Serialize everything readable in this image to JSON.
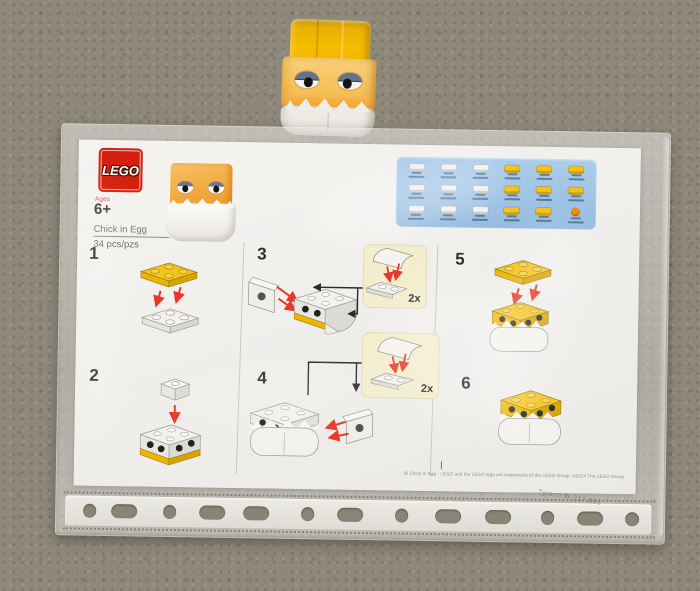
{
  "sheet": {
    "brand": "LEGO",
    "ages_label": "Ages",
    "age": "6+",
    "title": "Chick in Egg",
    "piece_count": "34 pcs/pzs",
    "steps": [
      "1",
      "2",
      "3",
      "4",
      "5",
      "6"
    ],
    "callouts": [
      {
        "qty": "2x"
      },
      {
        "qty": "2x"
      }
    ],
    "fine_print": "BI Chick in Egg · LEGO and the LEGO logo are trademarks of the LEGO Group. ©2024 The LEGO Group"
  },
  "sleeve": {
    "recycling_stamp": "Tyreco ♻ 317.881"
  },
  "parts_box": {
    "cells": [
      "white",
      "white",
      "white",
      "yellow",
      "yellow",
      "yellow",
      "white",
      "white",
      "white",
      "yellow",
      "yellow",
      "yellow",
      "white",
      "white",
      "white",
      "yellow",
      "yellow",
      "orange"
    ]
  },
  "colors": {
    "lego_red": "#d6200f",
    "parts_panel_blue": "#9fc3e6",
    "plate_yellow": "#f4c21d",
    "arrow_red": "#e8382b",
    "callout_cream": "#f3edcd",
    "carpet": "#8e887b"
  }
}
